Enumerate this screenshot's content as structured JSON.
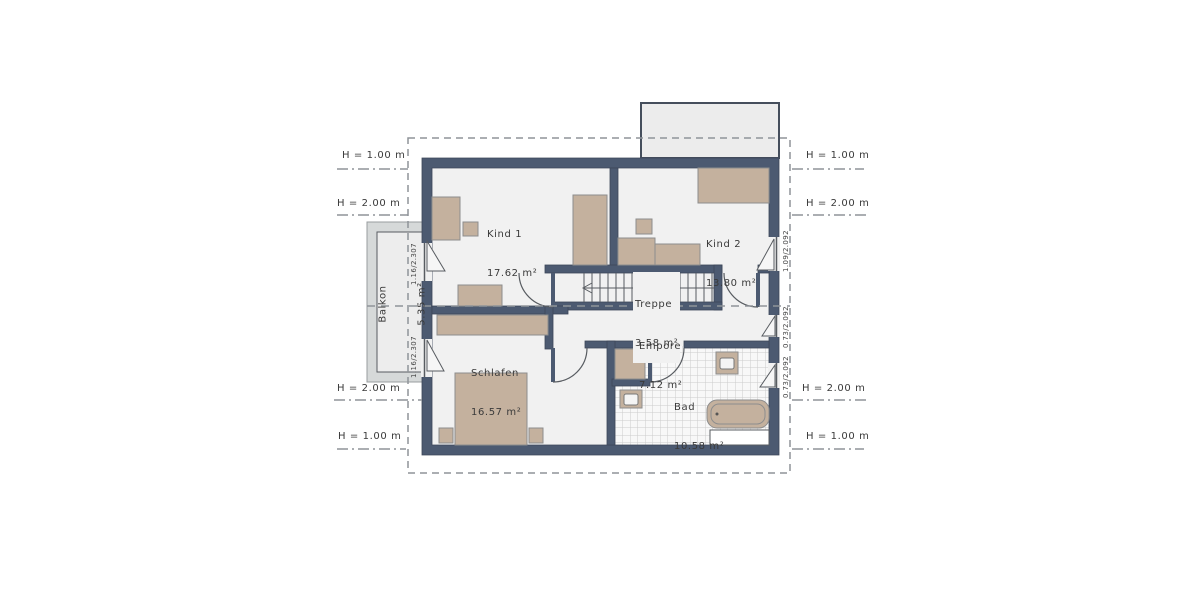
{
  "plan_type": "floor-plan",
  "rooms": {
    "kind1": {
      "name": "Kind 1",
      "area": "17.62 m²"
    },
    "kind2": {
      "name": "Kind 2",
      "area": "13.80 m²"
    },
    "treppe": {
      "name": "Treppe",
      "area": "3.58 m²"
    },
    "empore": {
      "name": "Empore",
      "area": "7.12 m²"
    },
    "schlafen": {
      "name": "Schlafen",
      "area": "16.57 m²"
    },
    "bad": {
      "name": "Bad",
      "area": "10.58 m²"
    },
    "balkon": {
      "name": "Balkon",
      "area": "5.35 m²"
    }
  },
  "height_markers": {
    "left": [
      "H = 1.00 m",
      "H = 2.00 m",
      "H = 2.00 m",
      "H = 1.00 m"
    ],
    "right": [
      "H = 1.00 m",
      "H = 2.00 m",
      "H = 2.00 m",
      "H = 1.00 m"
    ]
  },
  "window_dimensions": {
    "left": [
      "1.16/2.307",
      "1.16/2.307"
    ],
    "right": [
      "1.09/2.092",
      "0.73/2.092",
      "0.73/2.092"
    ]
  },
  "colors": {
    "wall": "#4c5a71",
    "furniture": "#c4b19e",
    "floor": "#f1f1f1",
    "balcony_rail": "#d6d9d9",
    "balcony_floor": "#ededed",
    "dormer": "#ececec",
    "dashed_line": "#8f9499",
    "thin_line": "#585c61",
    "text": "#3a3a3a"
  }
}
